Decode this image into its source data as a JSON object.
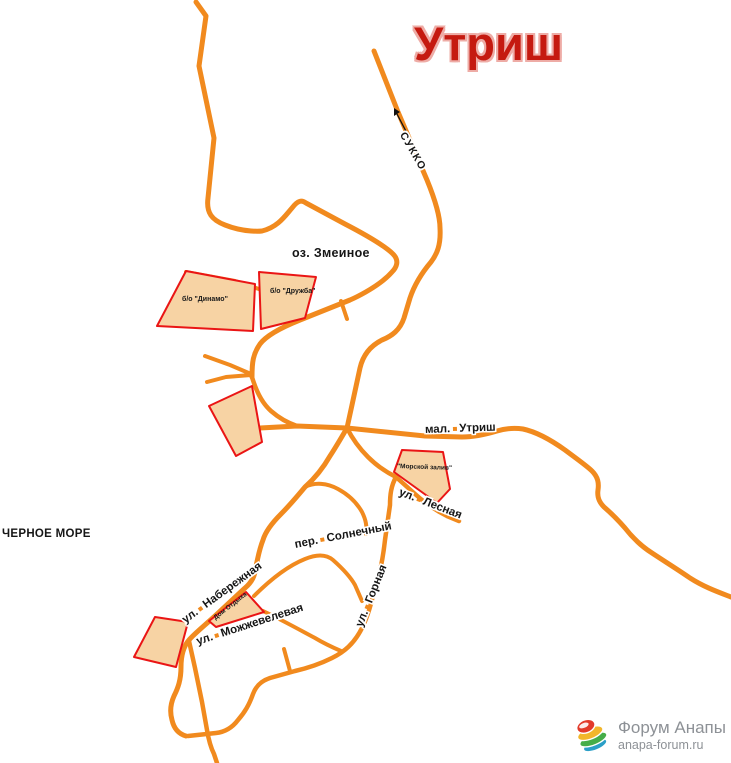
{
  "title": {
    "text": "Утриш"
  },
  "colors": {
    "road": "#f18a1e",
    "area_fill": "#f7d3a4",
    "area_stroke": "#ea1515",
    "title": "#c51a10",
    "title_halo": "#eeaca6",
    "label": "#161616",
    "arrow": "#111111"
  },
  "watermark": {
    "name": "Форум Анапы",
    "site": "anapa-forum.ru"
  },
  "map": {
    "roads": [
      {
        "name": "road-north-coast",
        "w": 5,
        "d": "M196,2 L206,16 L199,66 L214,138 L208,198 C206,213 212,220 225,225 C245,233 262,231 262,231 C278,227 285,216 292,208 C298,200 302,200 306,203 L345,224 C370,237 386,247 393,254 C400,261 396,268 392,272 C378,288 350,300 350,300 L300,320 C280,328 266,336 260,344 C253,354 252,362 252,377"
      },
      {
        "name": "road-sukko",
        "w": 5,
        "d": "M374,51 L398,112 L427,180 C436,202 440,218 440,228 C441,245 437,254 431,262 C420,275 414,286 410,298 L404,318 C400,330 392,336 382,340 C370,346 363,355 360,368 L352,405 L347,428 C340,440 334,450 330,456 C322,470 314,479 305,487 C295,499 288,507 281,514 C270,525 265,533 263,540 C259,550 258,558 256,566 C255,576 252,582 245,588 L215,616 C204,626 194,634 189,640 C183,647 181,656 181,667 C181,680 178,688 174,696 C170,705 170,713 172,720 C174,729 179,734 186,736"
      },
      {
        "name": "road-shore-south",
        "w": 4.5,
        "d": "M189,641 L195,668 L202,702 L207,730 C209,742 212,750 214,754 L217,763"
      },
      {
        "name": "road-gornaya",
        "w": 4.5,
        "d": "M396,477 C391,486 390,495 390,505 L385,540 C383,558 380,574 375,588 C371,604 368,616 362,628 C354,644 344,652 332,658 C320,664 308,668 295,671 L270,678 C261,681 256,686 253,694 C249,705 245,712 238,720 C232,728 225,732 216,733 L188,736"
      },
      {
        "name": "road-mal-utrish",
        "w": 5,
        "d": "M260,428 L297,426 L347,428 L425,436 L462,437 C475,437 487,434 497,431 C507,428 516,428 523,429 C537,432 551,440 565,450 C577,459 587,466 592,471 C598,477 599,483 598,490 C597,497 599,502 604,507 C611,513 618,520 625,528 C632,537 641,546 652,553 C664,561 677,569 690,578 C704,587 718,592 731,597"
      },
      {
        "name": "road-junction-south",
        "w": 4.5,
        "d": "M252,377 C257,394 263,404 271,411 C279,418 288,423 297,426"
      },
      {
        "name": "road-west-stub-1",
        "w": 4,
        "d": "M205,356 L230,365 L251,374"
      },
      {
        "name": "road-west-stub-2",
        "w": 4,
        "d": "M207,382 L226,377 L251,375"
      },
      {
        "name": "road-lesnaya",
        "w": 4.5,
        "d": "M347,428 C353,440 360,449 368,457 C377,466 386,472 396,477 L415,494 C426,504 437,511 447,516 L459,521"
      },
      {
        "name": "road-solnechny",
        "w": 4,
        "d": "M305,487 C315,482 327,483 338,489 C349,495 357,503 362,512 C366,520 367,526 366,534"
      },
      {
        "name": "road-arc-east",
        "w": 4,
        "d": "M254,596 C272,578 290,565 305,559 C317,554 326,554 333,560 C342,568 350,576 355,585 L362,601"
      },
      {
        "name": "road-mozhzhevelevaya",
        "w": 4,
        "d": "M263,611 C282,620 300,630 315,638 C325,644 334,648 341,651"
      },
      {
        "name": "road-t-stub",
        "w": 4,
        "d": "M284,649 L290,671"
      },
      {
        "name": "road-lake-edge",
        "w": 4,
        "d": "M186,272 L235,281 L262,290 C276,296 286,306 291,318"
      },
      {
        "name": "road-druzhba-stub",
        "w": 4,
        "d": "M341,301 L347,319"
      }
    ],
    "areas": [
      {
        "name": "area-dinamo",
        "points": "186,271 157,326 253,331 255,284"
      },
      {
        "name": "area-druzhba",
        "points": "259,272 316,277 305,318 261,329"
      },
      {
        "name": "area-center-camp",
        "points": "252,386 209,406 236,456 262,442"
      },
      {
        "name": "area-morskoy-zaliv",
        "points": "402,450 443,452 450,489 437,503 394,472"
      },
      {
        "name": "area-dom-otdyha",
        "points": "209,621 246,592 264,612 216,627"
      },
      {
        "name": "area-southwest",
        "points": "155,617 188,622 176,667 134,657"
      }
    ],
    "labels": [
      {
        "name": "sukko-label",
        "type": "street",
        "parts": [
          "СУККО"
        ],
        "x": 402,
        "y": 128,
        "rot": 60,
        "size": 10.5,
        "ls": 1.5
      },
      {
        "name": "oz-zmeinoe-label",
        "type": "plain",
        "parts": [
          "оз. Змеиное"
        ],
        "x": 292,
        "y": 247,
        "rot": 0,
        "size": 12.5
      },
      {
        "name": "chernoe-more-label",
        "type": "plain",
        "parts": [
          "ЧЕРНОЕ МОРЕ"
        ],
        "x": 2,
        "y": 529,
        "rot": 0,
        "size": 11.5
      },
      {
        "name": "mal-utrish-label",
        "type": "street",
        "parts": [
          "мал.",
          "Утриш"
        ],
        "x": 425,
        "y": 425,
        "rot": -2,
        "size": 11.5,
        "dot": true
      },
      {
        "name": "lesnaya-label",
        "type": "street",
        "parts": [
          "ул.",
          "Лесная"
        ],
        "x": 399,
        "y": 487,
        "rot": 21,
        "size": 11.5,
        "dot": true
      },
      {
        "name": "naberezhnaya-label",
        "type": "street",
        "parts": [
          "ул.",
          "Набережная"
        ],
        "x": 184,
        "y": 616,
        "rot": -36,
        "size": 11.5,
        "dot": true
      },
      {
        "name": "mozhzhevelevaya-label",
        "type": "street",
        "parts": [
          "ул.",
          "Можжевелевая"
        ],
        "x": 197,
        "y": 637,
        "rot": -18,
        "size": 11.5,
        "dot": true
      },
      {
        "name": "gornaya-label",
        "type": "street",
        "parts": [
          "ул.",
          "Горная"
        ],
        "x": 360,
        "y": 621,
        "rot": -68,
        "size": 11.5,
        "dot": true
      },
      {
        "name": "solnechny-label",
        "type": "street",
        "parts": [
          "пер.",
          "Солнечный"
        ],
        "x": 295,
        "y": 540,
        "rot": -11,
        "size": 11.5,
        "dot": true
      },
      {
        "name": "morskoy-zaliv-label",
        "type": "area",
        "parts": [
          "\"Морской залив\""
        ],
        "x": 397,
        "y": 464,
        "rot": 2,
        "size": 6.5
      },
      {
        "name": "dinamo-label",
        "type": "area",
        "parts": [
          "б/о \"Динамо\""
        ],
        "x": 182,
        "y": 296,
        "rot": 0,
        "size": 7
      },
      {
        "name": "druzhba-label",
        "type": "area",
        "parts": [
          "б/о \"Дружба\""
        ],
        "x": 270,
        "y": 288,
        "rot": 0,
        "size": 7
      },
      {
        "name": "dom-otdyha-label",
        "type": "area",
        "parts": [
          "Дом Отдыха"
        ],
        "x": 215,
        "y": 616,
        "rot": -38,
        "size": 6.5
      }
    ],
    "arrow": {
      "line": [
        409,
        137,
        397,
        114
      ],
      "head": "394,108 400,112 394,116"
    }
  }
}
